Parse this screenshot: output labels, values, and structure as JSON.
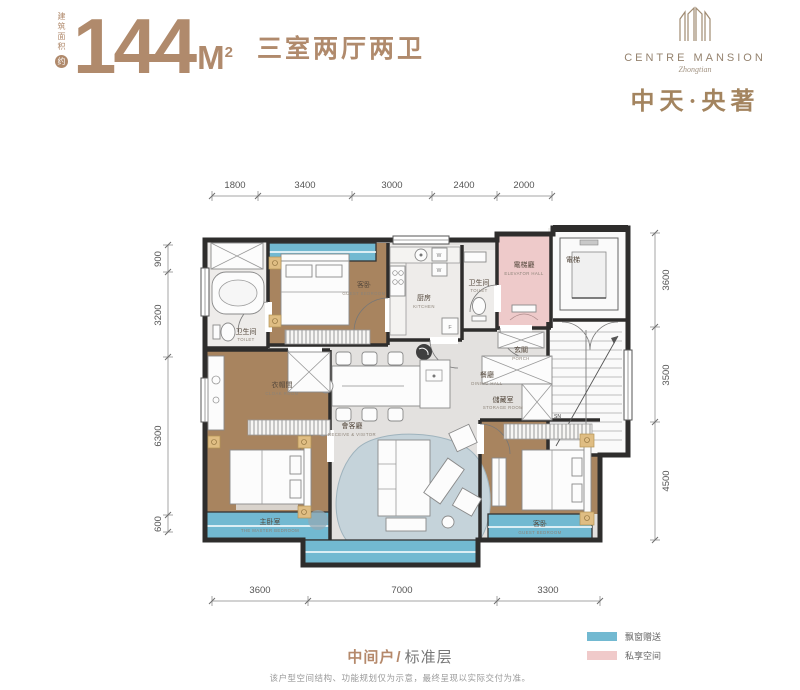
{
  "header": {
    "area_label": "建筑面积",
    "area_approx": "约",
    "area_number": "144",
    "area_unit": "M",
    "area_exponent": "2",
    "layout": "三室两厅两卫"
  },
  "logo": {
    "en": "CENTRE MANSION",
    "script": "Zhongtian",
    "cn": "中天·央著"
  },
  "dims": {
    "top": [
      "1800",
      "3400",
      "3000",
      "2400",
      "2000"
    ],
    "left": [
      "900",
      "3200",
      "6300",
      "600"
    ],
    "right": [
      "3600",
      "3500",
      "4500"
    ],
    "bottom": [
      "3600",
      "7000",
      "3300"
    ]
  },
  "rooms": {
    "bath_top": {
      "cn": "卫生间",
      "en": "TOILET"
    },
    "guest_top": {
      "cn": "客卧",
      "en": "GUEST BEDROOM"
    },
    "kitchen": {
      "cn": "厨房",
      "en": "KITCHEN"
    },
    "bath_mid": {
      "cn": "卫生间",
      "en": "TOILET"
    },
    "elevator_hall": {
      "cn": "電梯廳",
      "en": "ELEVATOR HALL"
    },
    "elevator": {
      "cn": "電梯"
    },
    "porch": {
      "cn": "玄關",
      "en": "PORCH"
    },
    "dining": {
      "cn": "餐廳",
      "en": "DINING HALL"
    },
    "storage": {
      "cn": "儲藏室",
      "en": "STORAGE ROOM"
    },
    "living": {
      "cn": "會客廳",
      "en": "RECEIVE & VISITOR"
    },
    "cloak": {
      "cn": "衣帽間",
      "en": "CLOAK ROOM"
    },
    "master": {
      "cn": "主卧室",
      "en": "THE MASTER BEDROOM"
    },
    "guest_bottom": {
      "cn": "客卧",
      "en": "GUEST BEDROOM"
    },
    "stair_mark": "SN",
    "fridge_mark": "F",
    "washer_mark": "W"
  },
  "legend": {
    "bay_window": {
      "label": "飘窗赠送",
      "color": "#72b9d1"
    },
    "private": {
      "label": "私享空间",
      "color": "#f0caca"
    }
  },
  "footer": {
    "unit": "中间户",
    "slash": "/",
    "floor": "标准层",
    "disclaimer": "该户型空间结构、功能规划仅为示意，最终呈现以实际交付为准。"
  }
}
